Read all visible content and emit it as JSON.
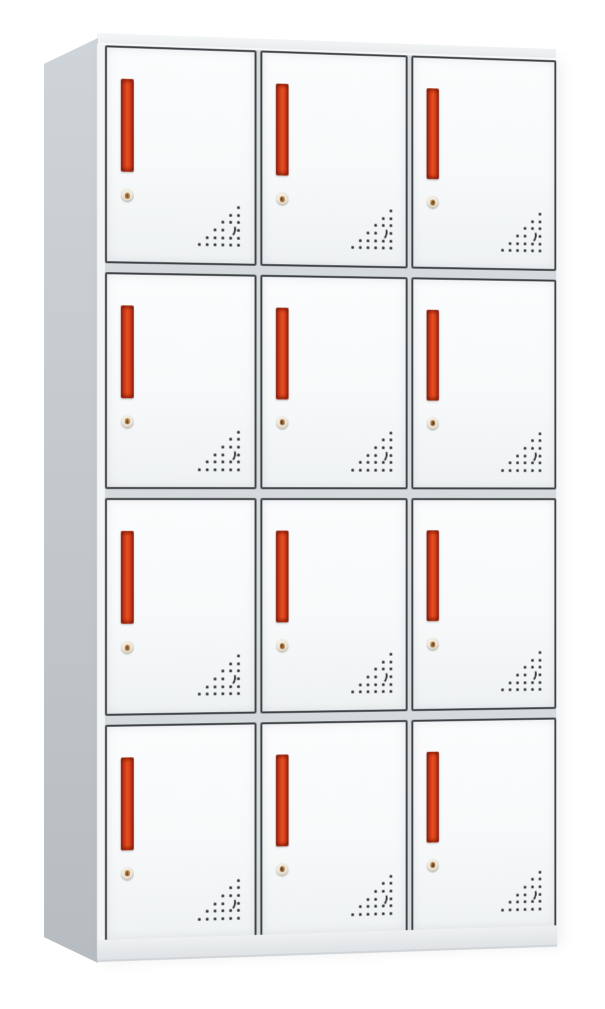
{
  "scene": {
    "subject": "metal-locker-cabinet",
    "view": "three-quarter-front-left",
    "background_color": "#ffffff",
    "text_visible": "none"
  },
  "cabinet": {
    "rows": 4,
    "columns": 3,
    "door_count": 12,
    "door": {
      "handle_icon": "vertical-red-bar-handle",
      "lock_icon": "cylinder-keyhole-lock",
      "vent_icon": "triangular-perforation-pattern"
    },
    "vent": {
      "grid_rows": 6,
      "grid_cols": 6,
      "pattern": "right-triangle-bottom-right",
      "crescent_cell": {
        "row": 4,
        "col": 5
      }
    },
    "colors": {
      "door_face": "#f7f9fa",
      "door_border": "#3e4246",
      "gap_color": "#d5dadd",
      "handle_red": "#e95120",
      "handle_dark": "#8a2512",
      "side_panel_1": "#ced4d8",
      "side_panel_2": "#b6bcc0",
      "top_face": "#eef0f2",
      "base_1": "#eef0f1",
      "base_2": "#dfe3e5",
      "vent_dot": "#2c2f32",
      "lock_core": "#bd8348"
    }
  }
}
